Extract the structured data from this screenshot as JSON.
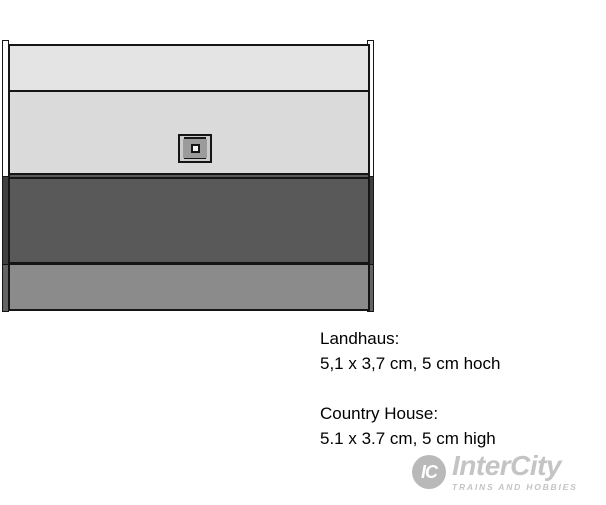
{
  "figure": {
    "name": "Landhaus / Country House technical drawing, top view",
    "outline_color": "#151515",
    "bands": [
      {
        "name": "upper-roof-panel",
        "fill": "#e4e4e4",
        "css": "background:#e4e4e4"
      },
      {
        "name": "main-roof-panel",
        "fill": "#dadada",
        "css": "background:#dadada"
      },
      {
        "name": "shadow-roof-panel",
        "fill": "#595959",
        "css": "background:#595959"
      },
      {
        "name": "base-panel",
        "fill": "#8b8b8b",
        "css": "background:#8b8b8b"
      }
    ],
    "posts": {
      "upper_fill": "#fbfbfb",
      "dark_fill": "#3f3f3f",
      "base_fill": "#636363"
    },
    "chimney": {
      "outer_fill": "#cbcbcb",
      "frame_fill": "#181818",
      "ring_fill": "#9b9b9b",
      "cap_fill": "#f2f2f2"
    }
  },
  "caption": {
    "german": {
      "title": "Landhaus:",
      "dimensions": "5,1 x 3,7 cm, 5 cm hoch"
    },
    "english": {
      "title": "Country House:",
      "dimensions": "5.1 x 3.7 cm, 5 cm high"
    }
  },
  "logo": {
    "monogram": "IC",
    "brand": "InterCity",
    "tagline": "TRAINS AND HOBBIES",
    "color": "#c4c4c4",
    "css": "color:#c4c4c4"
  }
}
